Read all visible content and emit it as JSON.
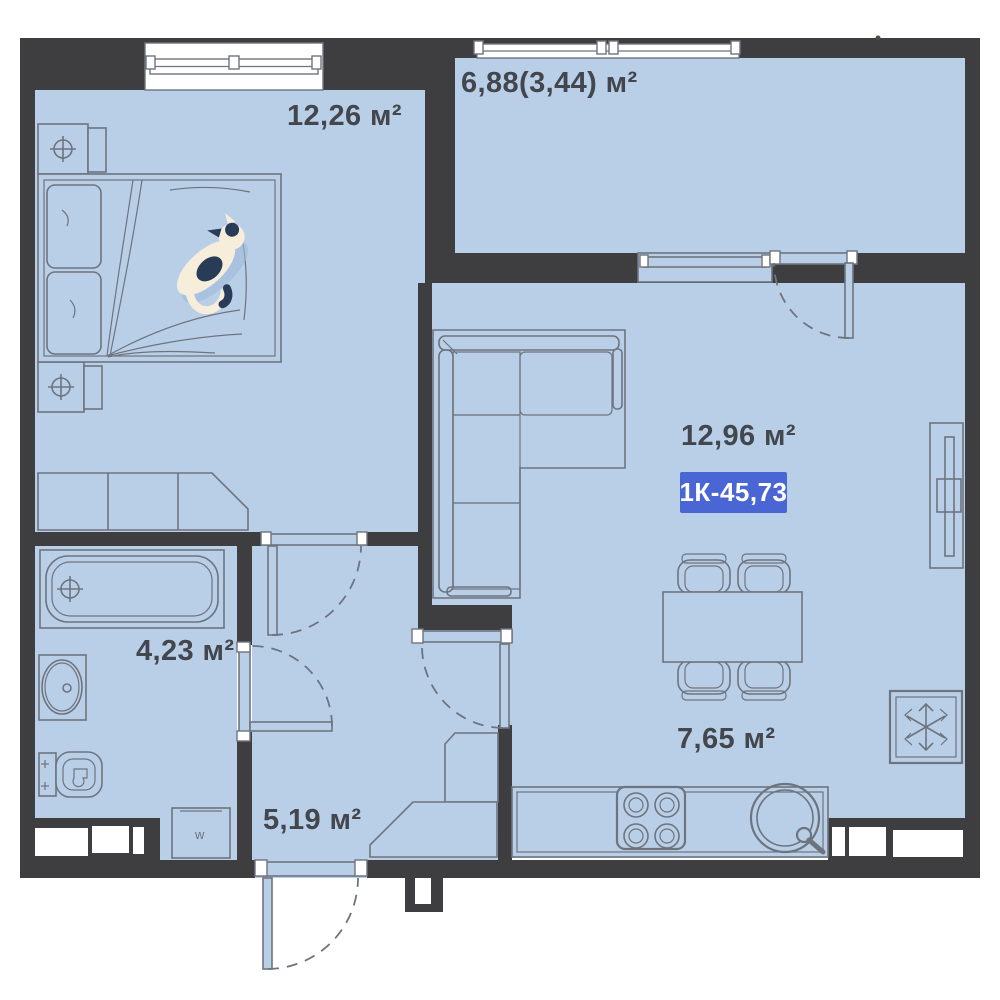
{
  "plan": {
    "unit_badge": {
      "label": "1К-45,73"
    },
    "rooms": {
      "bedroom": {
        "area": "12,26 м²"
      },
      "balcony": {
        "area": "6,88(3,44) м²"
      },
      "living_room": {
        "area": "12,96 м²"
      },
      "bathroom": {
        "area": "4,23 м²"
      },
      "hallway": {
        "area": "5,19 м²"
      },
      "kitchen": {
        "area": "7,65 м²"
      }
    },
    "fixtures": {
      "washer_mark": "w"
    },
    "colors": {
      "wall": "#3e3e41",
      "floor": "#b9cfe8",
      "line": "#6e747e",
      "label_text": "#43474d",
      "badge_bg": "#4a66d4",
      "badge_text": "#ffffff",
      "cat_body": "#f6eedb",
      "cat_marks": "#283c58"
    }
  }
}
